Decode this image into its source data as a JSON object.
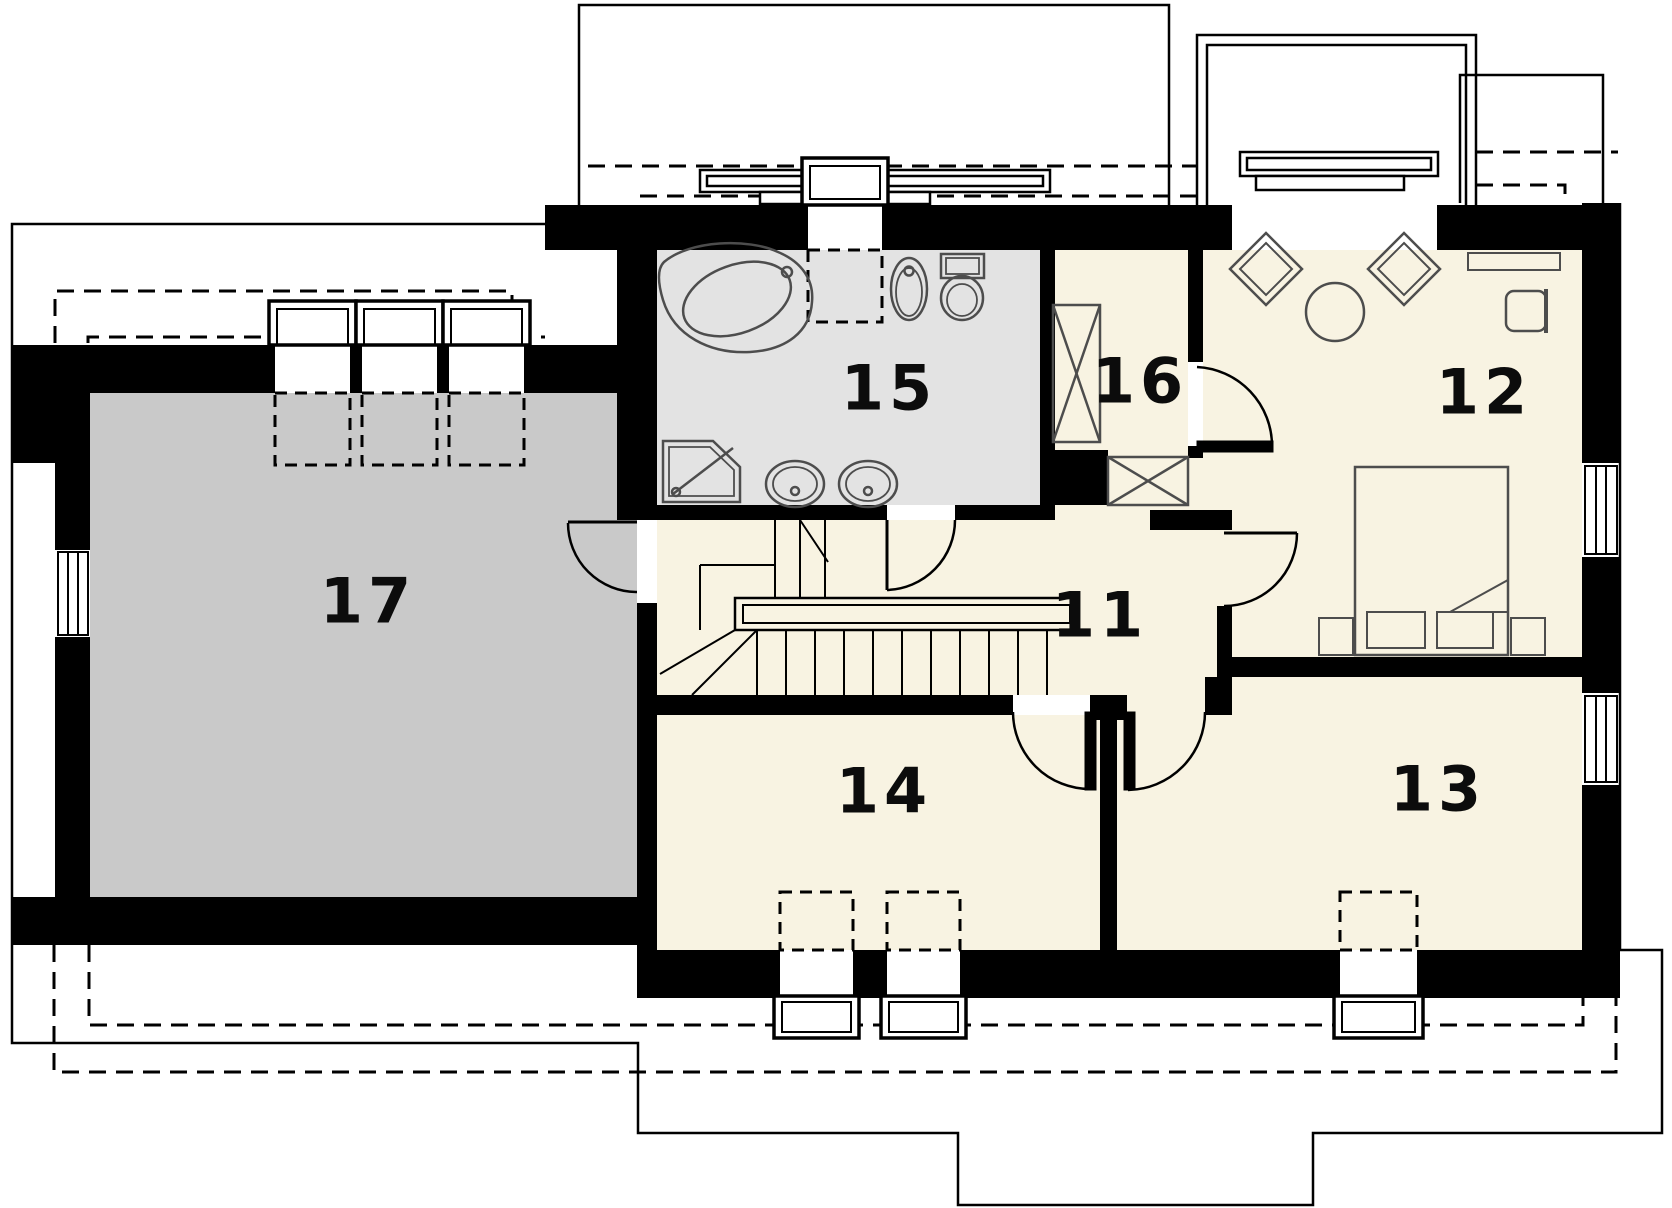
{
  "floor_plan": {
    "rooms": [
      {
        "number": "17",
        "fill": "#c9c9c9"
      },
      {
        "number": "15",
        "fill": "#e3e3e3"
      },
      {
        "number": "16",
        "fill": "#f8f3e2"
      },
      {
        "number": "12",
        "fill": "#f8f3e2"
      },
      {
        "number": "11",
        "fill": "#f8f3e2"
      },
      {
        "number": "14",
        "fill": "#f8f3e2"
      },
      {
        "number": "13",
        "fill": "#f8f3e2"
      }
    ],
    "colors": {
      "walls": "#000000",
      "attic_floor": "#c9c9c9",
      "bathroom_floor": "#e3e3e3",
      "room_floor": "#f8f3e2",
      "furniture_stroke": "#4d4d4d",
      "background": "#ffffff"
    },
    "fixtures": [
      "corner-bathtub",
      "shower",
      "washbasin",
      "washbasin",
      "bidet",
      "toilet",
      "wardrobe",
      "wardrobe",
      "staircase",
      "bed",
      "nightstand",
      "nightstand",
      "pillow",
      "pillow",
      "armchair",
      "armchair",
      "round-table",
      "desk",
      "chair"
    ],
    "counts": {
      "roof_windows": 7,
      "wall_windows": 3,
      "dormer_windows": 2,
      "doors": 6
    }
  }
}
